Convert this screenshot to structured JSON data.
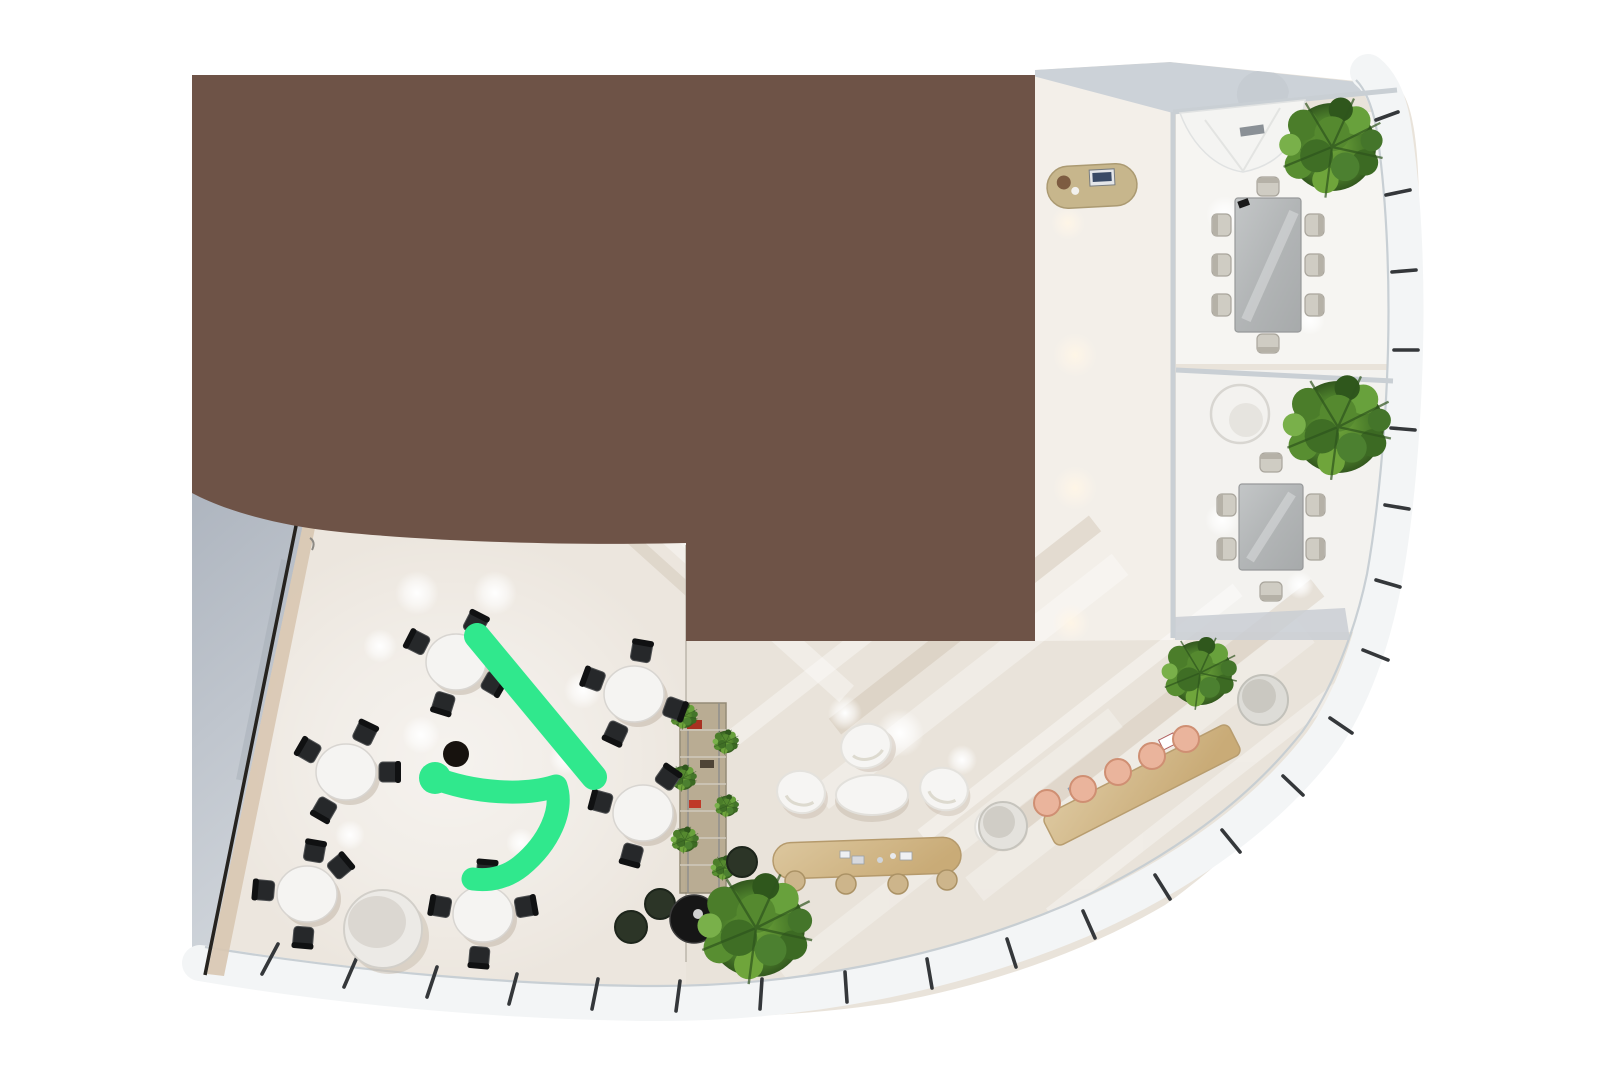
{
  "meta": {
    "description": "Top-down 3D render of a curved office floor plan with a large brown redaction overlay and a hand-drawn green annotation mark",
    "view": "floor-plan-top-view"
  },
  "colors": {
    "page_bg": "#ffffff",
    "brown_overlay": "#6e5347",
    "annotation_green": "#30e88d",
    "floor_base": "#e9e3da",
    "floor_dining": "#ece6de",
    "floor_meeting": "#f6f5f2",
    "floor_meeting2": "#f3f2ef",
    "floor_corridor": "#f3efe9",
    "terrace_dark": "#b0b7c0",
    "terrace_light": "#cfd4da",
    "roof_gray": "#ccd2d8",
    "facade_band": "#f3f5f6",
    "facade_line": "#c5ccd2",
    "facade_tick": "#34373a",
    "wall_line": "#c9cfd4",
    "wall_dark": "#26231f",
    "wall_beige": "#d8c7b1",
    "dining_table": "#f5f4f2",
    "dining_chair": "#26282a",
    "dining_chair_back": "#101112",
    "conf_table_light": "#c3c6c7",
    "conf_table_dark": "#a7aaab",
    "meeting_chair": "#cfccc3",
    "meeting_chair_frame": "#a9a59c",
    "counter_light": "#dcc79e",
    "counter_dark": "#c9ab77",
    "stool_peach": "#eab49c",
    "desk_tan": "#c7b68c",
    "shelf_tan": "#b5a88d",
    "plant_dark": "#3a6423",
    "plant_mid": "#578a33",
    "plant_light": "#79aa45",
    "pot_dark": "#2c3527",
    "bowl_black": "#161616",
    "pot_white": "#dddcd7",
    "lounge_white": "#f6f5f3",
    "cylinder_white": "#eceae6"
  },
  "annotation": {
    "tool": "freehand-marker",
    "stroke_width": 25,
    "stroke_count": 2,
    "shape": "diagonal line plus bent arrow over cafeteria tables"
  },
  "scene": {
    "counts": {
      "dining_tables": 6,
      "dining_chairs": 24,
      "meeting_rooms": 2,
      "conference_chairs": 14,
      "bar_stools": 5,
      "pill_table_stools": 4,
      "lounge_chairs": 4,
      "large_plants": 4,
      "facade_mullions": 23
    },
    "regions": [
      "redacted-brown-block",
      "cafeteria-dining-area",
      "central-lounge",
      "bar-counter",
      "meeting-room-1",
      "meeting-room-2",
      "corridor",
      "terrace-left",
      "curved-glass-facade"
    ]
  }
}
